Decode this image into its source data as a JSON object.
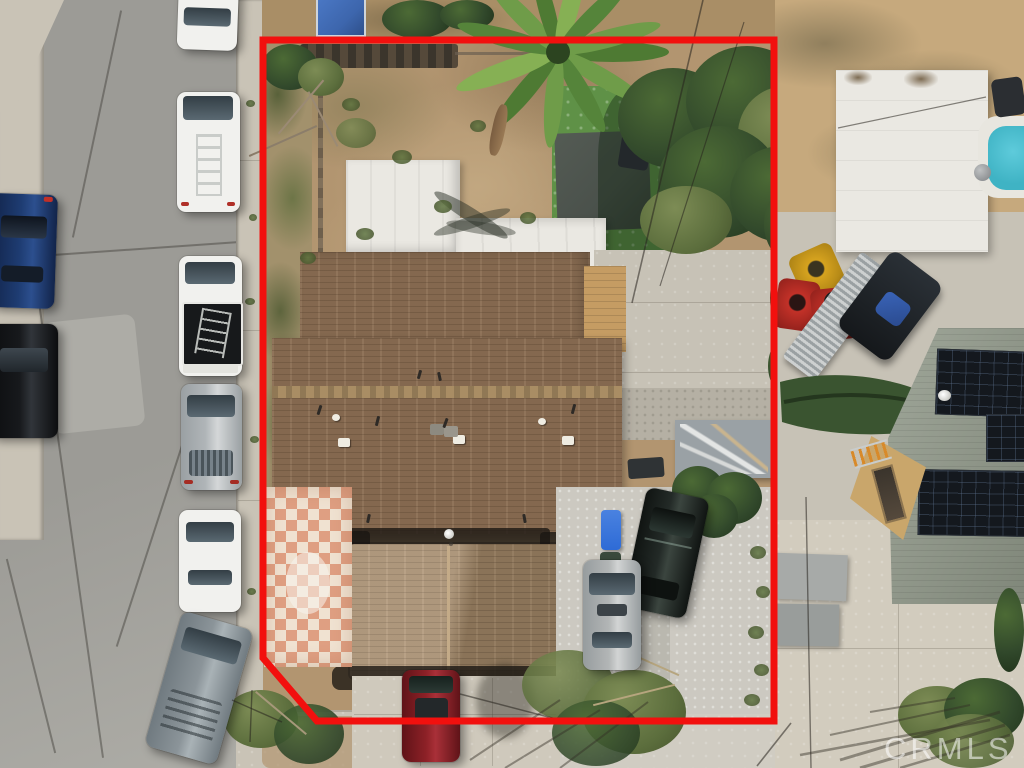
{
  "photo": {
    "kind": "aerial-drone-view",
    "subject": "Residential lot outlined in red: main house with brown shingle roof, backyard with turf and palm, gravel driveway with parked cars, street parking on left, neighbor lot with pool, canopy, ATVs and solar roof on right",
    "width_px": 1024,
    "height_px": 768
  },
  "watermark": {
    "text": "CRMLS"
  },
  "boundary": {
    "color": "#f2100e",
    "stroke_width": 7,
    "points": "263,40 774,40 774,721 317,721 263,658"
  },
  "palette": {
    "asphalt": "#9c9b96",
    "asphalt-light": "#adaca6",
    "sidewalk": "#c9c3b6",
    "concrete": "#c7c2b6",
    "concrete-warm": "#cfc9bc",
    "gravel": "#ccc9c1",
    "dirt": "#b29570",
    "dirt-dark": "#8d7455",
    "dirt-light": "#ccb58d",
    "sand": "#c6a97d",
    "grass-olive": "#74814a",
    "turf-green": "#5f9147",
    "tarp-gray": "#4a514b",
    "tree-dark": "#31482b",
    "tree-mid": "#44613a",
    "tree-light": "#6d8f4a",
    "roof-brown": "#8b6e53",
    "roof-ridge": "#a98d64",
    "roof-front": "#a98d6c",
    "roof-tan": "#c59c63",
    "white-roof": "#eae8e2",
    "checker-pink": "#df9f82",
    "checker-cream": "#f0e2d1",
    "pool-blue": "#3fb3c4",
    "neighbor-roof": "#929a8b",
    "wall-tan": "#c9a66b",
    "shed-gray": "#9aa1a5",
    "trailer-silver": "#cdd0d0",
    "quad-red": "#c23128",
    "quad-yellow": "#d6a31f",
    "bin-blue": "#2e6bd6",
    "car-red": "#8e2127",
    "car-blue": "#1e3c72",
    "car-black": "#17191c",
    "car-silver": "#b0b5b8",
    "car-white": "#f1f1ee",
    "suv-gray": "#8b9499",
    "watermark-color": "rgba(255,255,255,0.55)"
  },
  "scene": {
    "street_left": {
      "surface": "asphalt",
      "parked_cars_west_side": [
        "dark-blue-sedan",
        "black-sedan"
      ],
      "parked_cars_east_side": [
        "white-car",
        "white-van-roof-ladder",
        "white-pickup-black-bed",
        "silver-sedan",
        "white-sedan",
        "gray-suv"
      ]
    },
    "subject_property": {
      "roofs": [
        "brown-shingle-main-roof",
        "tan-roof-section",
        "front-hip-roof",
        "white-flat-roof-garage",
        "white-flat-roof-addition"
      ],
      "yard": [
        "dirt-backyard",
        "green-turf-patch",
        "dark-tarp",
        "palm-tree",
        "shade-tree",
        "checkerboard-tile-patio",
        "hedge-row",
        "gray-storage-shed",
        "gravel-parking-area",
        "blue-recycle-bin"
      ],
      "vehicles": [
        "black-suv",
        "silver-sedan",
        "dark-red-car"
      ]
    },
    "neighbor_right": {
      "features": [
        "sandy-yard",
        "white-canopy-roof",
        "swimming-pool-edge",
        "atv-quads",
        "aluminum-trailer",
        "dark-utv",
        "italian-cypress-tree",
        "green-roof-with-solar-panels",
        "tan-exterior-wall",
        "concrete-driveway",
        "tree-with-long-shadows"
      ]
    },
    "bottom": {
      "features": [
        "front-sidewalk",
        "driveway-apron",
        "shrubs"
      ]
    }
  }
}
